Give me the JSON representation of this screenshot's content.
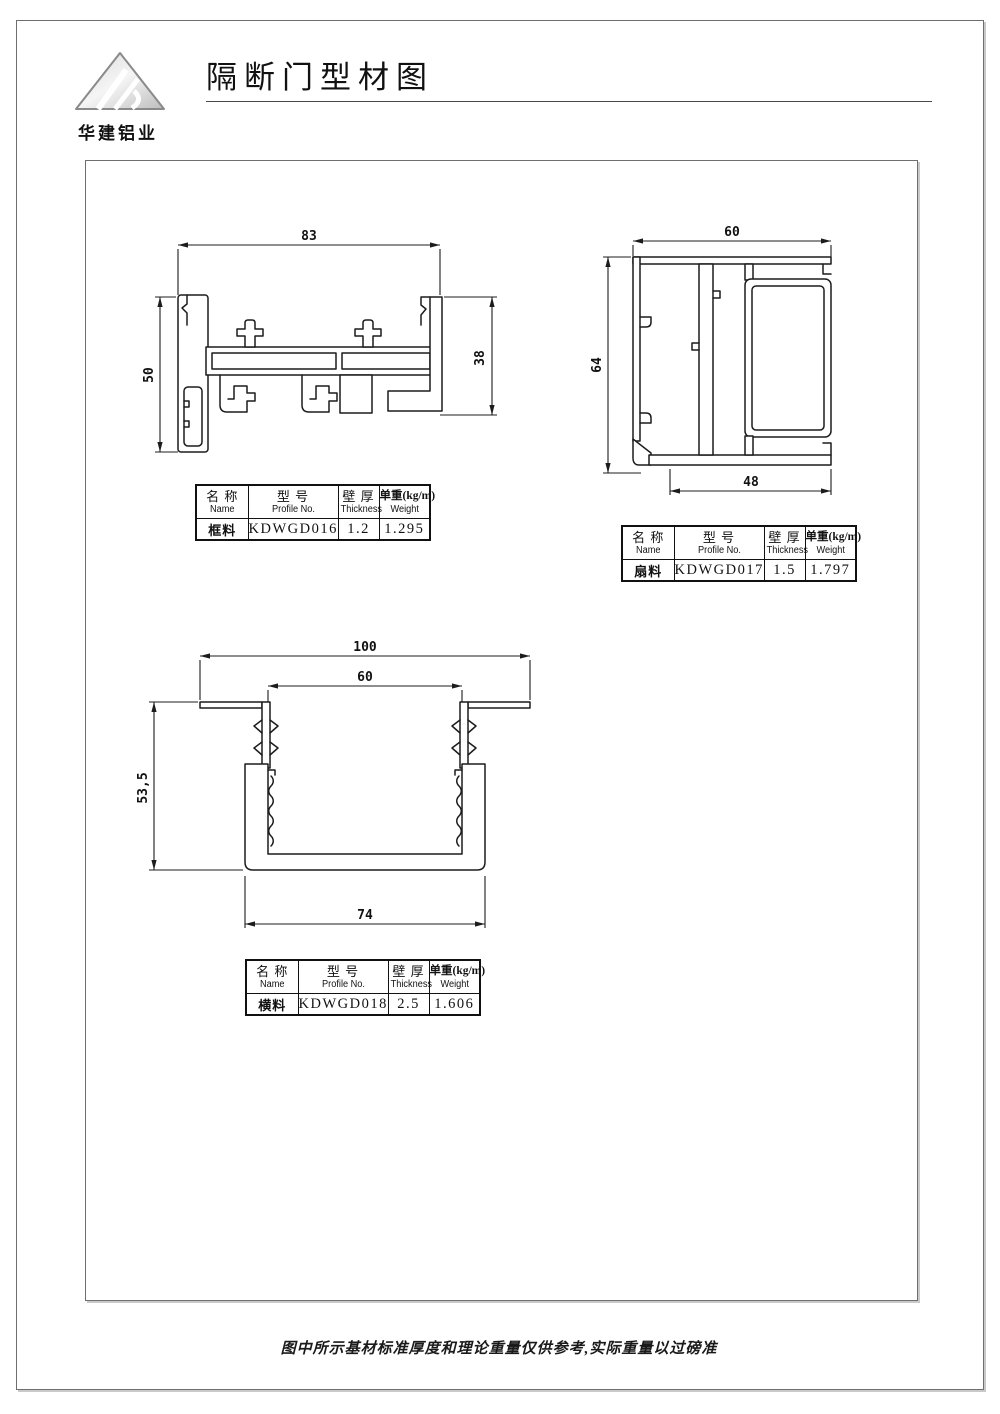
{
  "header": {
    "title": "隔断门型材图",
    "brand": "华建铝业"
  },
  "table_headers": {
    "name_zh": "名 称",
    "name_en": "Name",
    "model_zh": "型 号",
    "model_en": "Profile No.",
    "thickness_zh": "壁 厚",
    "thickness_en": "Thickness",
    "weight_zh": "单重(kg/m)",
    "weight_en": "Weight"
  },
  "profiles": [
    {
      "name": "框料",
      "profile_no": "KDWGD016",
      "thickness": "1.2",
      "weight": "1.295",
      "dims": {
        "top": "83",
        "left": "50",
        "right": "38"
      }
    },
    {
      "name": "扇料",
      "profile_no": "KDWGD017",
      "thickness": "1.5",
      "weight": "1.797",
      "dims": {
        "top": "60",
        "left": "64",
        "bottom": "48"
      }
    },
    {
      "name": "横料",
      "profile_no": "KDWGD018",
      "thickness": "2.5",
      "weight": "1.606",
      "dims": {
        "top": "100",
        "inner_top": "60",
        "left": "53,5",
        "bottom": "74"
      }
    }
  ],
  "footer": {
    "note": "图中所示基材标准厚度和理论重量仅供参考,实际重量以过磅准"
  },
  "colors": {
    "line": "#1c1c1c",
    "frame": "#6f6f6f",
    "shadow": "#c9c9c9"
  }
}
